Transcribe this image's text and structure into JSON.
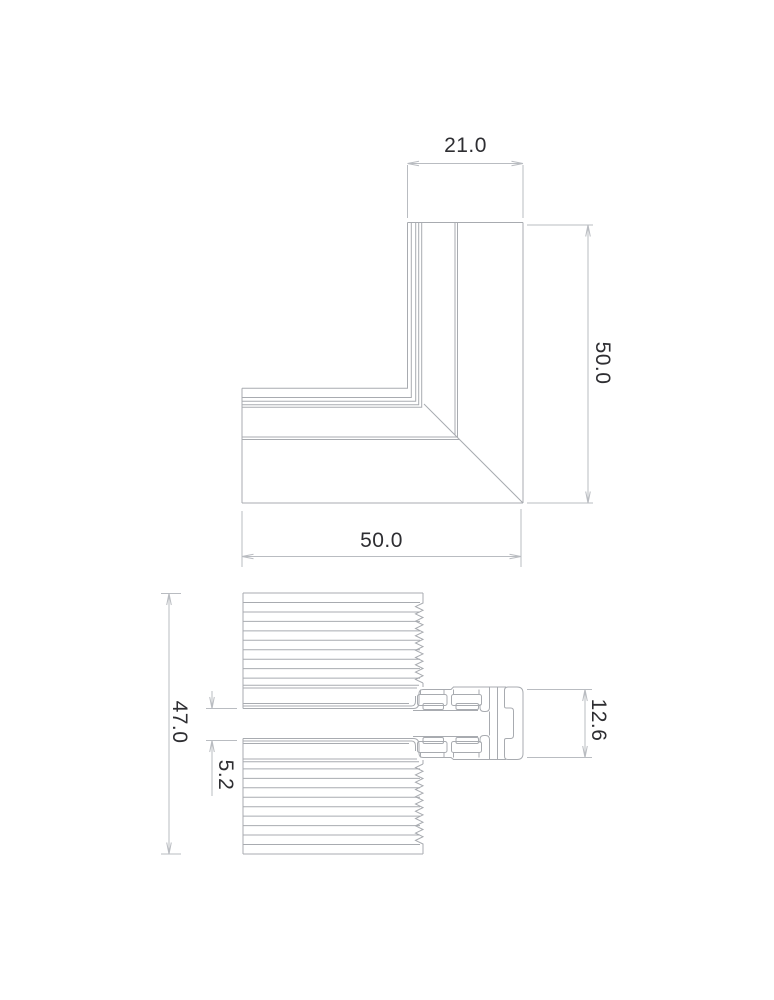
{
  "drawing": {
    "title": "profile-corner-technical-drawing",
    "background_color": "#ffffff",
    "profile_line_color": "#a8abb0",
    "dimension_line_color": "#b9bcc1",
    "text_color": "#2e2e32"
  },
  "corner_view": {
    "name": "corner-joint-plan-view",
    "dimensions": [
      {
        "id": "top-width",
        "value": "21.0",
        "orientation": "horizontal"
      },
      {
        "id": "right-height",
        "value": "50.0",
        "orientation": "vertical"
      },
      {
        "id": "bottom-width",
        "value": "50.0",
        "orientation": "horizontal"
      }
    ]
  },
  "section_view": {
    "name": "profile-cross-section-view",
    "dimensions": [
      {
        "id": "overall-height",
        "value": "47.0",
        "orientation": "vertical"
      },
      {
        "id": "slot-gap",
        "value": "5.2",
        "orientation": "vertical"
      },
      {
        "id": "profile-height",
        "value": "12.6",
        "orientation": "vertical"
      }
    ]
  }
}
